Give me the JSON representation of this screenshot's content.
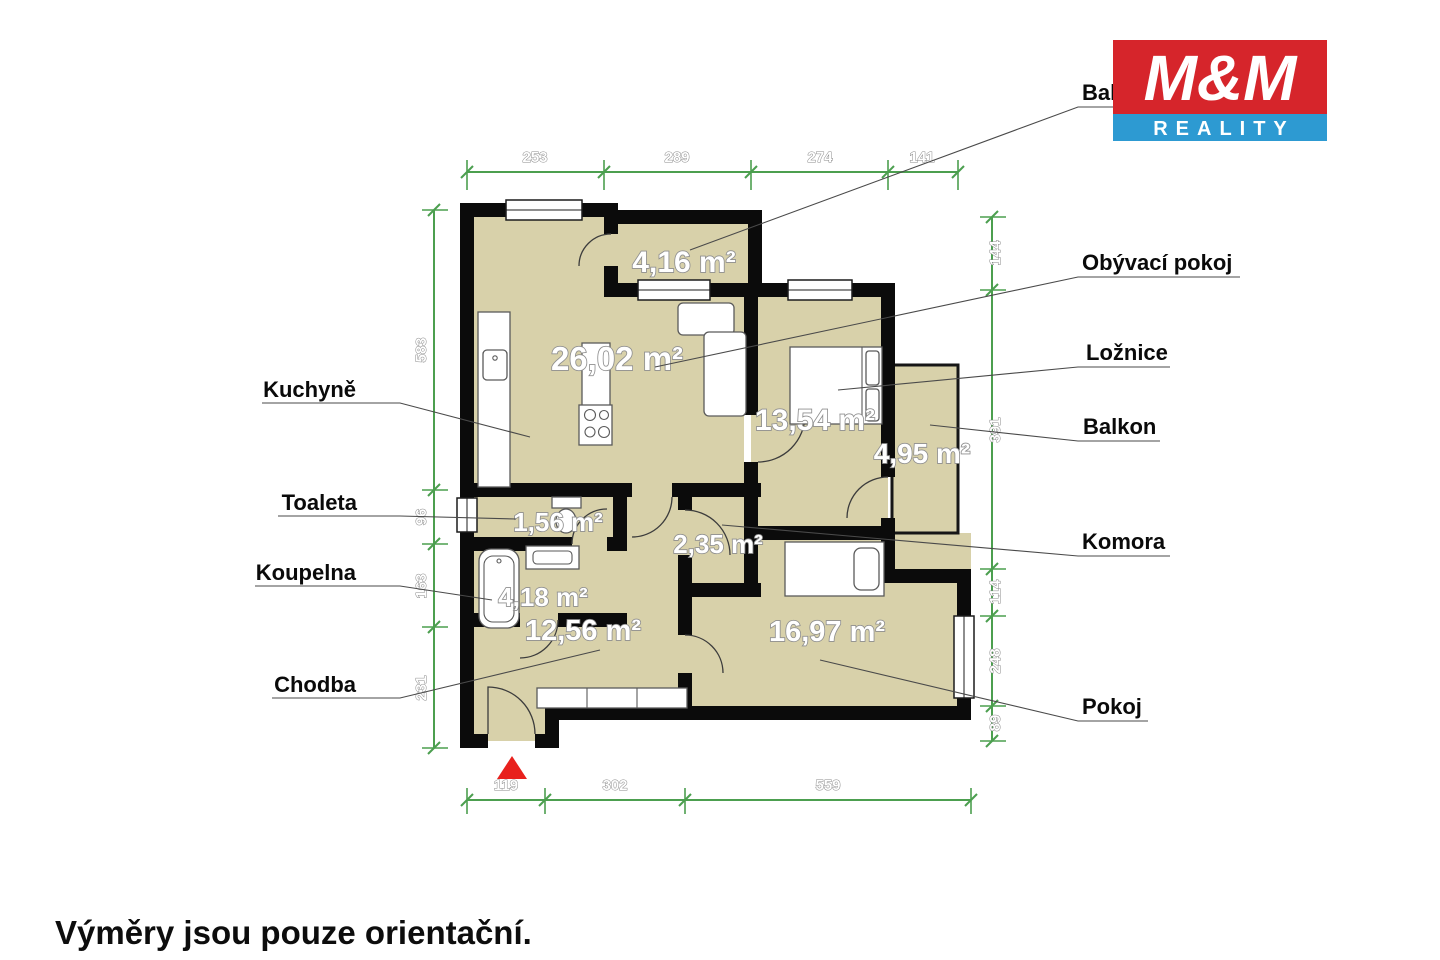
{
  "logo": {
    "line1": "M&M",
    "line2": "REALITY",
    "red": "#d6252b",
    "blue": "#2d9ad2"
  },
  "disclaimer": "Výměry jsou pouze orientační.",
  "rooms": {
    "balkon_top": {
      "label": "Balkon",
      "area": "4,16 m²"
    },
    "obyvaci_pokoj": {
      "label": "Obývací pokoj",
      "area": "26,02 m²"
    },
    "kuchyne": {
      "label": "Kuchyně"
    },
    "loznice": {
      "label": "Ložnice",
      "area": "13,54 m²"
    },
    "balkon_right": {
      "label": "Balkon",
      "area": "4,95 m²"
    },
    "toaleta": {
      "label": "Toaleta",
      "area": "1,56 m²"
    },
    "komora": {
      "label": "Komora",
      "area": "2,35 m²"
    },
    "koupelna": {
      "label": "Koupelna",
      "area": "4,18 m²"
    },
    "chodba": {
      "label": "Chodba",
      "area": "12,56 m²"
    },
    "pokoj": {
      "label": "Pokoj",
      "area": "16,97 m²"
    }
  },
  "dims": {
    "top": [
      "253",
      "289",
      "274",
      "141"
    ],
    "bottom": [
      "119",
      "302",
      "559"
    ],
    "left": [
      "583",
      "96",
      "163",
      "231"
    ],
    "right": [
      "144",
      "391",
      "114",
      "248",
      "89"
    ]
  },
  "colors": {
    "room_fill": "#d8d1aa",
    "wall": "#0b0b0b",
    "dimension_green": "#4c9f4f",
    "entry_marker_red": "#e8211d"
  }
}
